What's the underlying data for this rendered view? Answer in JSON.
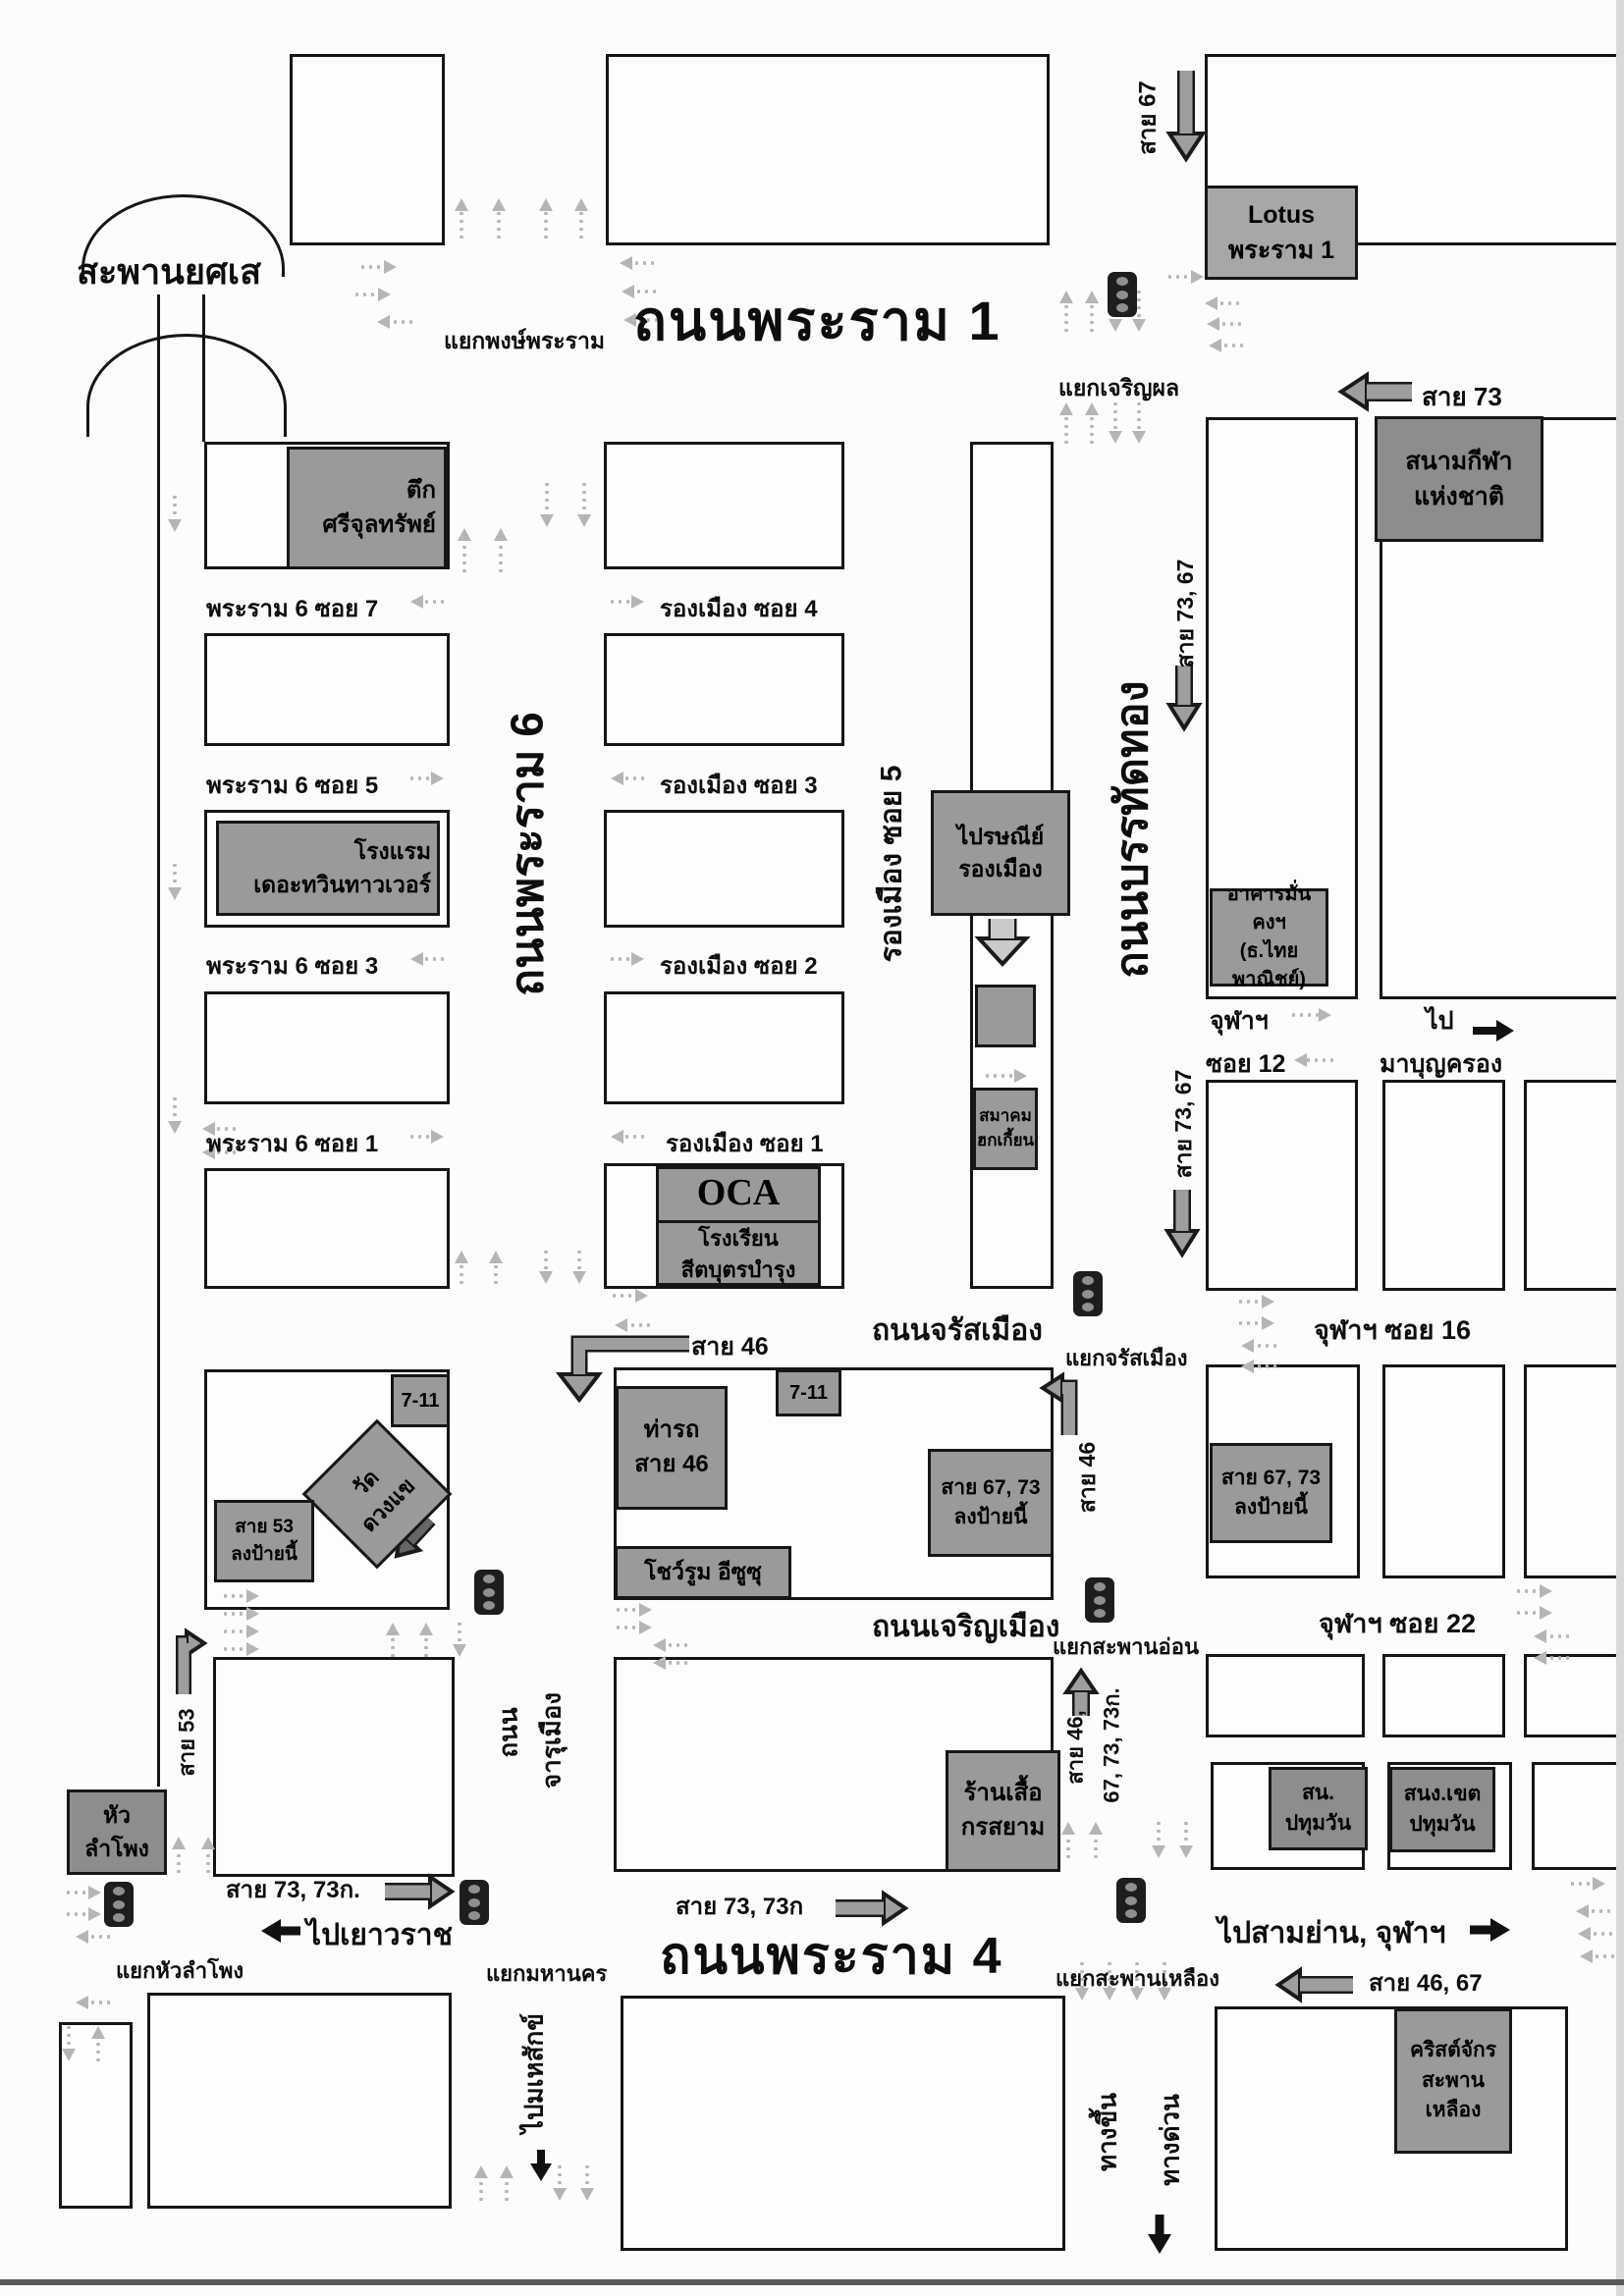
{
  "bridge": {
    "name": "สะพานยศเส"
  },
  "roads": {
    "rama1": "ถนนพระราม 1",
    "rama4": "ถนนพระราม 4",
    "rama6": "ถนนพระราม 6",
    "banthat_thong": "ถนนบรรทัดทอง",
    "rong_muang_soi5": "รองเมือง ซอย 5",
    "charat_muang": "ถนนจรัสเมือง",
    "charoen_muang": "ถนนเจริญเมือง",
    "charu_muang": {
      "line1": "ถนน",
      "line2": "จารุเมือง"
    },
    "rama6_soi7": "พระราม 6 ซอย 7",
    "rama6_soi5": "พระราม 6 ซอย 5",
    "rama6_soi3": "พระราม 6 ซอย 3",
    "rama6_soi1": "พระราม 6 ซอย 1",
    "rong_muang_soi4": "รองเมือง ซอย 4",
    "rong_muang_soi3": "รองเมือง ซอย 3",
    "rong_muang_soi2": "รองเมือง ซอย 2",
    "rong_muang_soi1": "รองเมือง ซอย 1",
    "chula_soi12": {
      "line1": "จุฬาฯ",
      "line2": "ซอย 12"
    },
    "chula_soi16": "จุฬาฯ ซอย 16",
    "chula_soi22": "จุฬาฯ ซอย 22"
  },
  "junctions": {
    "phong_phraram": "แยกพงษ์พระราม",
    "charoen_phol": "แยกเจริญผล",
    "charat_muang": "แยกจรัสเมือง",
    "saphan_on": "แยกสะพานอ่อน",
    "mahanakhon": "แยกมหานคร",
    "hua_lamphong": "แยกหัวลำโพง",
    "saphan_lueang": "แยกสะพานเหลือง"
  },
  "bus_routes": {
    "sai67": "สาย 67",
    "sai73": "สาย 73",
    "sai73_67_upper": "สาย 73, 67",
    "sai73_67_lower": "สาย 73, 67",
    "sai46_charat": "สาย 46",
    "sai46_turn": "สาย 46",
    "sai53": "สาย 53",
    "sai46_67_73_73k": {
      "line1": "สาย 46,",
      "line2": "67, 73, 73ก."
    },
    "sai73_73k_left": "สาย 73, 73ก.",
    "sai73_73k_center": "สาย 73, 73ก",
    "sai46_67": "สาย 46, 67"
  },
  "directions": {
    "to_yaowarat": "ไปเยาวราช",
    "to_samyan_chula": "ไปสามย่าน, จุฬาฯ",
    "to_mbk": {
      "line1": "ไป",
      "line2": "มาบุญครอง"
    },
    "to_mahesak": "ไปมเหสักข์",
    "expressway_entrance": "ทางขึ้น",
    "expressway": "ทางด่วน"
  },
  "landmarks": {
    "sri_chulasap": {
      "line1": "ตึก",
      "line2": "ศรีจุลทรัพย์"
    },
    "lotus_rama1": {
      "line1": "Lotus",
      "line2": "พระราม 1"
    },
    "national_stadium": {
      "line1": "สนามกีฬา",
      "line2": "แห่งชาติ"
    },
    "twin_towers_hotel": {
      "line1": "โรงแรม",
      "line2": "เดอะทวินทาวเวอร์"
    },
    "rong_muang_post_office": {
      "line1": "ไปรษณีย์",
      "line2": "รองเมือง"
    },
    "munkong_building": {
      "line1": "อาคารมั่นคงฯ",
      "line2": "(ธ.ไทยพาณิชย์)"
    },
    "hokkien_association": {
      "line1": "สมาคม",
      "line2": "ฮกเกี้ยน"
    },
    "oca_school": {
      "line1": "OCA",
      "line2": "โรงเรียน",
      "line3": "สีตบุตรบำรุง"
    },
    "seven_eleven_west": "7-11",
    "seven_eleven_east": "7-11",
    "wat_duang_khae": {
      "line1": "วัด",
      "line2": "ดวงแข"
    },
    "bus53_stop": {
      "line1": "สาย 53",
      "line2": "ลงป้ายนี้"
    },
    "bus46_terminal": {
      "line1": "ท่ารถ",
      "line2": "สาย 46"
    },
    "isuzu_showroom": "โชว์รูม อีซูซุ",
    "bus67_73_stop_west": {
      "line1": "สาย 67, 73",
      "line2": "ลงป้ายนี้"
    },
    "bus67_73_stop_east": {
      "line1": "สาย 67, 73",
      "line2": "ลงป้ายนี้"
    },
    "korsiam_shirt_shop": {
      "line1": "ร้านเสื้อ",
      "line2": "กรสยาม"
    },
    "hua_lamphong": {
      "line1": "หัว",
      "line2": "ลำโพง"
    },
    "pathumwan_police": {
      "line1": "สน.",
      "line2": "ปทุมวัน"
    },
    "pathumwan_district_office": {
      "line1": "สนง.เขต",
      "line2": "ปทุมวัน"
    },
    "saphan_lueang_church": {
      "line1": "คริสต์จักร",
      "line2": "สะพาน",
      "line3": "เหลือง"
    }
  },
  "colors": {
    "building_fill": "#9a9a9a",
    "route_arrow": "#9e9e9e",
    "dotted_arrow": "#b5b5b5",
    "line": "#151515"
  }
}
